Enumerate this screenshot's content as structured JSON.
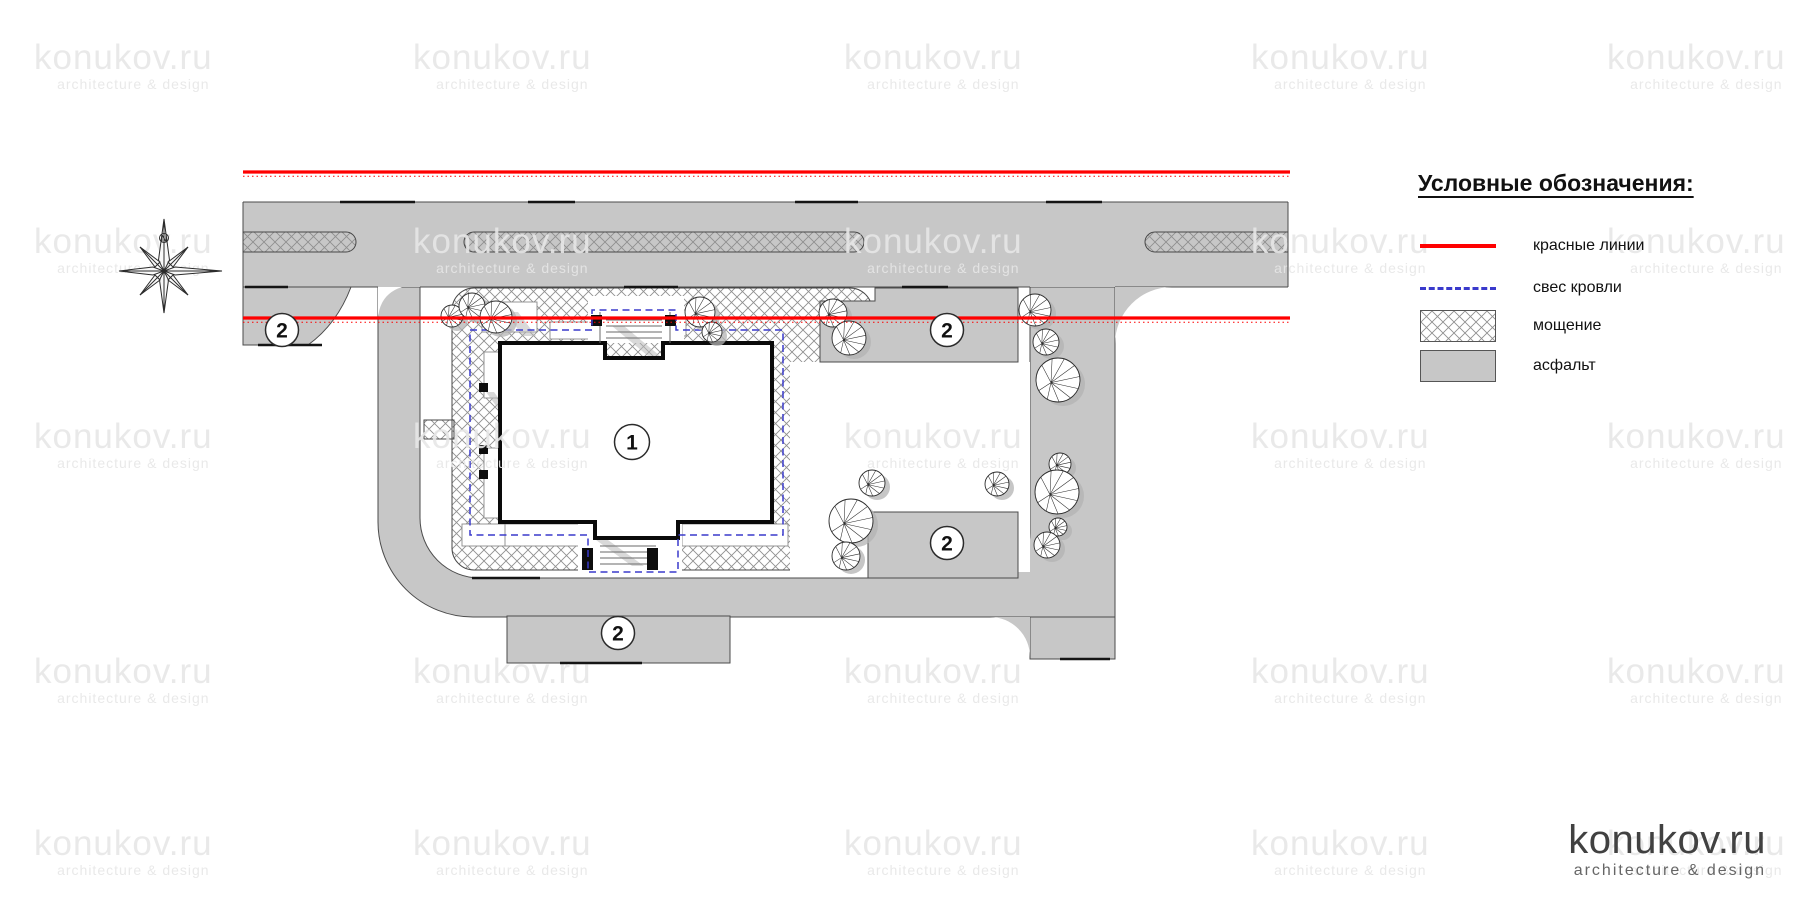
{
  "legend": {
    "title": "Условные обозначения:",
    "items": [
      {
        "type": "red-line",
        "label": "красные линии"
      },
      {
        "type": "dashed-line",
        "label": "свес кровли"
      },
      {
        "type": "hatch",
        "label": "мощение"
      },
      {
        "type": "asphalt",
        "label": "асфальт"
      }
    ]
  },
  "plan": {
    "building_label": "1",
    "area_label": "2",
    "compass_label": "N"
  },
  "logo": {
    "name": "konukov.ru",
    "tagline": "architecture & design"
  },
  "watermark": {
    "line1": "konukov.ru",
    "line2": "architecture & design"
  },
  "colors": {
    "red_line": "#ff0000",
    "roof_overhang": "#3a3acc",
    "asphalt": "#c7c7c7",
    "hatch_line": "#8f8f8f"
  }
}
